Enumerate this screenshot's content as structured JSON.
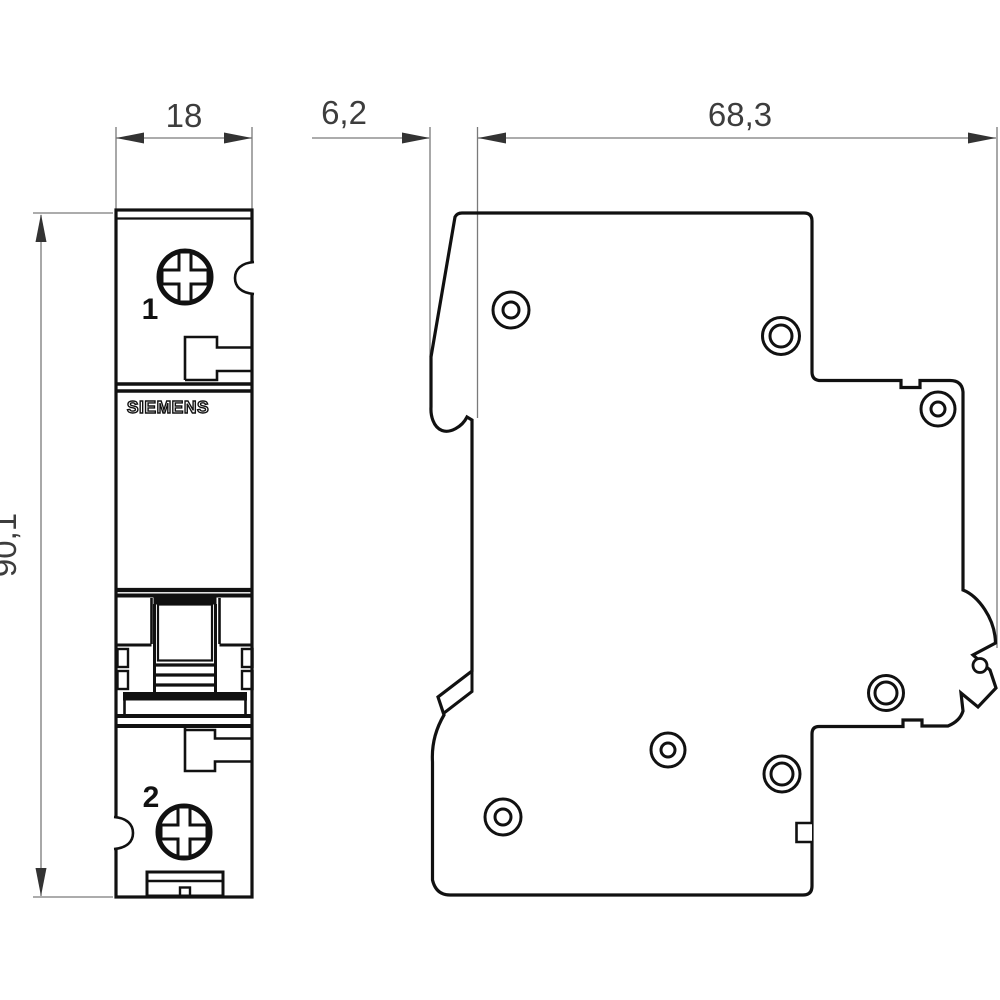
{
  "drawing": {
    "title": "Miniature circuit breaker dimension drawing, front and side view",
    "brand_label": "SIEMENS",
    "dimensions": {
      "width_mm": "18",
      "rail_offset_mm": "6,2",
      "depth_mm": "68,3",
      "height_mm": "90,1"
    },
    "terminals": {
      "top_label": "1",
      "bottom_label": "2"
    },
    "colors": {
      "outline": "#111111",
      "dim_line": "#7a7a7a",
      "arrow": "#333333",
      "dim_text": "#3d3d3d",
      "background": "#ffffff"
    }
  }
}
